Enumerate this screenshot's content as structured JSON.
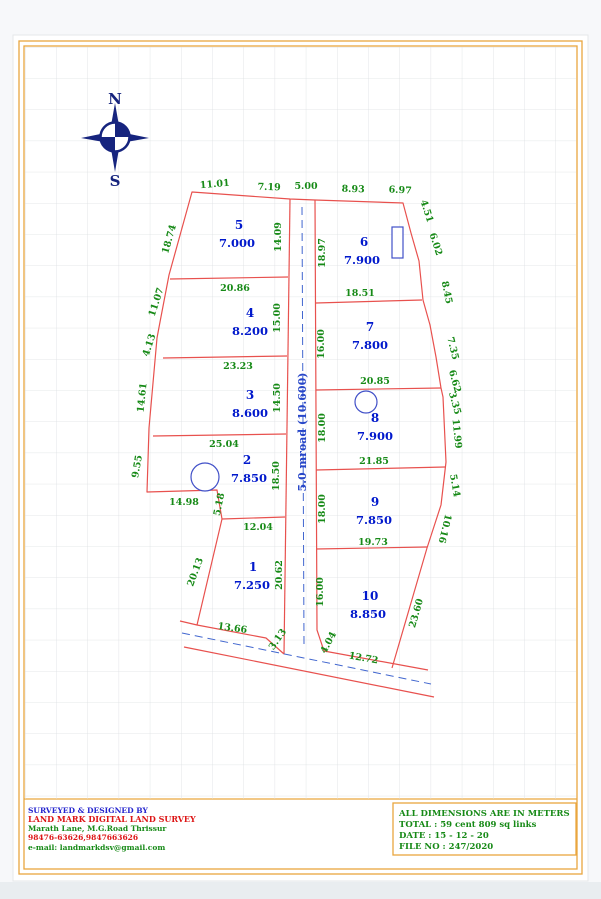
{
  "sheet": {
    "compass": {
      "north": "N",
      "south": "S"
    },
    "road_label": "5.0 mroad (10.600)",
    "plots": [
      {
        "number": "1",
        "area": "7.250"
      },
      {
        "number": "2",
        "area": "7.850"
      },
      {
        "number": "3",
        "area": "8.600"
      },
      {
        "number": "4",
        "area": "8.200"
      },
      {
        "number": "5",
        "area": "7.000"
      },
      {
        "number": "6",
        "area": "7.900"
      },
      {
        "number": "7",
        "area": "7.800"
      },
      {
        "number": "8",
        "area": "7.900"
      },
      {
        "number": "9",
        "area": "7.850"
      },
      {
        "number": "10",
        "area": "8.850"
      }
    ],
    "dims": {
      "t1": "11.01",
      "t2": "7.19",
      "t3": "5.00",
      "t4": "8.93",
      "t5": "6.97",
      "r1": "4.51",
      "r2": "6.02",
      "r3": "8.45",
      "r4": "7.35",
      "r5": "6.62",
      "r6": "3.35",
      "r7": "11.99",
      "r8": "5.14",
      "r9": "10.16",
      "r10": "23.60",
      "l1": "18.74",
      "l2": "11.07",
      "l3": "4.13",
      "l4": "14.61",
      "l5": "9.55",
      "l6": "20.13",
      "v5": "14.09",
      "v6": "18.97",
      "v4": "15.00",
      "v7": "16.00",
      "v3": "14.50",
      "v8": "18.00",
      "v2": "18.50",
      "v9": "18.00",
      "v1": "20.62",
      "v10": "16.00",
      "vn": "5.18",
      "h45": "20.86",
      "h34": "23.23",
      "h23": "25.04",
      "hn": "14.98",
      "h12": "12.04",
      "h67": "18.51",
      "h78": "20.85",
      "h89": "21.85",
      "h910": "19.73",
      "b1": "13.66",
      "b2": "3.13",
      "b3": "4.04",
      "b4": "12.72"
    },
    "footer_left": {
      "line1": "SURVEYED & DESIGNED BY",
      "line2": "LAND MARK DIGITAL LAND SURVEY",
      "line3": "Marath Lane, M.G.Road Thrissur",
      "line4": "98476-63626,9847663626",
      "line5": "e-mail: landmarkdsv@gmail.com"
    },
    "footer_right": {
      "line1": "ALL DIMENSIONS ARE IN METERS",
      "line2": "TOTAL : 59 cent 809 sq links",
      "line3": "DATE : 15 - 12 - 20",
      "line4": "FILE NO : 247/2020"
    },
    "colors": {
      "frame": "#E9A63F",
      "boundary_red": "#E8514E",
      "dimension_green": "#178A17",
      "plot_blue": "#0018CC",
      "road_blue": "#4166CF",
      "compass_blue": "#16247E"
    }
  }
}
